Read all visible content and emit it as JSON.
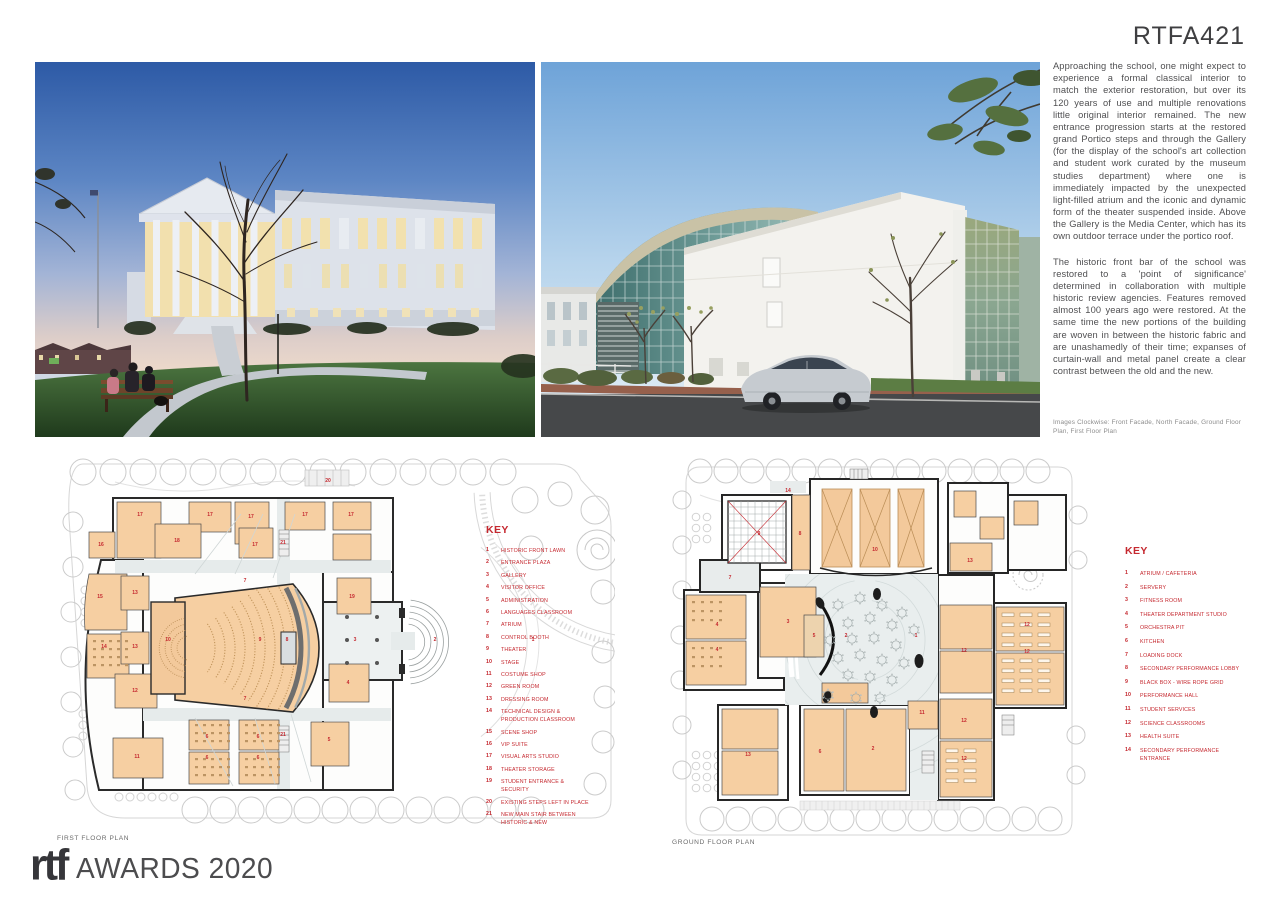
{
  "header": {
    "code": "RTFA421"
  },
  "article": {
    "paragraphs": [
      "Approaching the school, one might expect to experience a formal classical interior to match the exterior restoration, but over its 120 years of use and multiple renovations little original interior remained. The new entrance progression starts at the restored grand Portico steps and through the Gallery (for the display of the school's art collection and student work curated by the museum studies department) where one is immediately impacted by the unexpected light-filled atrium and the iconic and dynamic form of the theater suspended inside. Above the Gallery is the Media Center, which has its own outdoor terrace under the portico roof.",
      "The historic front bar of the school was restored to a 'point of significance' determined in collaboration with multiple historic review agencies. Features removed almost 100 years ago were restored. At the same time the new portions of the building are woven in between the historic fabric and are unashamedly of their time; expanses of curtain-wall and metal panel create a clear contrast between the old and the new."
    ],
    "caption": "Images Clockwise: Front Facade, North Facade, Ground Floor Plan, First Floor Plan"
  },
  "plans": {
    "first": {
      "label": "FIRST FLOOR PLAN",
      "key_title": "KEY",
      "key": [
        {
          "n": "1",
          "label": "HISTORIC FRONT LAWN"
        },
        {
          "n": "2",
          "label": "ENTRANCE PLAZA"
        },
        {
          "n": "3",
          "label": "GALLERY"
        },
        {
          "n": "4",
          "label": "VISITOR OFFICE"
        },
        {
          "n": "5",
          "label": "ADMINISTRATION"
        },
        {
          "n": "6",
          "label": "LANGUAGES CLASSROOM"
        },
        {
          "n": "7",
          "label": "ATRIUM"
        },
        {
          "n": "8",
          "label": "CONTROL BOOTH"
        },
        {
          "n": "9",
          "label": "THEATER"
        },
        {
          "n": "10",
          "label": "STAGE"
        },
        {
          "n": "11",
          "label": "COSTUME SHOP"
        },
        {
          "n": "12",
          "label": "GREEN ROOM"
        },
        {
          "n": "13",
          "label": "DRESSING ROOM"
        },
        {
          "n": "14",
          "label": "TECHNICAL DESIGN & PRODUCTION CLASSROOM"
        },
        {
          "n": "15",
          "label": "SCENE SHOP"
        },
        {
          "n": "16",
          "label": "VIP SUITE"
        },
        {
          "n": "17",
          "label": "VISUAL ARTS STUDIO"
        },
        {
          "n": "18",
          "label": "THEATER STORAGE"
        },
        {
          "n": "19",
          "label": "STUDENT ENTRANCE & SECURITY"
        },
        {
          "n": "20",
          "label": "EXISTING STEPS LEFT IN PLACE"
        },
        {
          "n": "21",
          "label": "NEW MAIN STAIR BETWEEN HISTORIC & NEW"
        }
      ],
      "room_labels": [
        {
          "t": "20",
          "x": 273,
          "y": 30
        },
        {
          "t": "17",
          "x": 85,
          "y": 64
        },
        {
          "t": "17",
          "x": 155,
          "y": 64
        },
        {
          "t": "17",
          "x": 196,
          "y": 66
        },
        {
          "t": "17",
          "x": 250,
          "y": 64
        },
        {
          "t": "17",
          "x": 296,
          "y": 64
        },
        {
          "t": "16",
          "x": 46,
          "y": 94
        },
        {
          "t": "18",
          "x": 122,
          "y": 90
        },
        {
          "t": "17",
          "x": 200,
          "y": 94
        },
        {
          "t": "21",
          "x": 228,
          "y": 92
        },
        {
          "t": "15",
          "x": 45,
          "y": 146
        },
        {
          "t": "13",
          "x": 80,
          "y": 142
        },
        {
          "t": "7",
          "x": 190,
          "y": 130
        },
        {
          "t": "19",
          "x": 297,
          "y": 146
        },
        {
          "t": "14",
          "x": 49,
          "y": 196
        },
        {
          "t": "13",
          "x": 80,
          "y": 196
        },
        {
          "t": "10",
          "x": 113,
          "y": 189
        },
        {
          "t": "9",
          "x": 205,
          "y": 189
        },
        {
          "t": "8",
          "x": 232,
          "y": 189
        },
        {
          "t": "3",
          "x": 300,
          "y": 189
        },
        {
          "t": "2",
          "x": 380,
          "y": 189
        },
        {
          "t": "1",
          "x": 478,
          "y": 189
        },
        {
          "t": "12",
          "x": 80,
          "y": 240
        },
        {
          "t": "7",
          "x": 190,
          "y": 248
        },
        {
          "t": "4",
          "x": 293,
          "y": 232
        },
        {
          "t": "11",
          "x": 82,
          "y": 306
        },
        {
          "t": "6",
          "x": 152,
          "y": 286
        },
        {
          "t": "6",
          "x": 203,
          "y": 286
        },
        {
          "t": "21",
          "x": 228,
          "y": 284
        },
        {
          "t": "5",
          "x": 274,
          "y": 289
        },
        {
          "t": "6",
          "x": 152,
          "y": 307
        },
        {
          "t": "6",
          "x": 203,
          "y": 307
        }
      ]
    },
    "ground": {
      "label": "GROUND FLOOR PLAN",
      "key_title": "KEY",
      "key": [
        {
          "n": "1",
          "label": "ATRIUM / CAFETERIA"
        },
        {
          "n": "2",
          "label": "SERVERY"
        },
        {
          "n": "3",
          "label": "FITNESS ROOM"
        },
        {
          "n": "4",
          "label": "THEATER DEPARTMENT STUDIO"
        },
        {
          "n": "5",
          "label": "ORCHESTRA PIT"
        },
        {
          "n": "6",
          "label": "KITCHEN"
        },
        {
          "n": "7",
          "label": "LOADING DOCK"
        },
        {
          "n": "8",
          "label": "SECONDARY PERFORMANCE LOBBY"
        },
        {
          "n": "9",
          "label": "BLACK BOX - WIRE ROPE GRID"
        },
        {
          "n": "10",
          "label": "PERFORMANCE HALL"
        },
        {
          "n": "11",
          "label": "STUDENT SERVICES"
        },
        {
          "n": "12",
          "label": "SCIENCE CLASSROOMS"
        },
        {
          "n": "13",
          "label": "HEALTH SUITE"
        },
        {
          "n": "14",
          "label": "SECONDARY PERFORMANCE ENTRANCE"
        }
      ],
      "room_labels": [
        {
          "t": "14",
          "x": 118,
          "y": 37
        },
        {
          "t": "9",
          "x": 89,
          "y": 80
        },
        {
          "t": "8",
          "x": 130,
          "y": 80
        },
        {
          "t": "10",
          "x": 205,
          "y": 96
        },
        {
          "t": "13",
          "x": 300,
          "y": 107
        },
        {
          "t": "7",
          "x": 60,
          "y": 124
        },
        {
          "t": "4",
          "x": 47,
          "y": 171
        },
        {
          "t": "3",
          "x": 118,
          "y": 168
        },
        {
          "t": "5",
          "x": 144,
          "y": 182
        },
        {
          "t": "2",
          "x": 176,
          "y": 182
        },
        {
          "t": "1",
          "x": 246,
          "y": 182
        },
        {
          "t": "12",
          "x": 357,
          "y": 171
        },
        {
          "t": "4",
          "x": 47,
          "y": 196
        },
        {
          "t": "12",
          "x": 294,
          "y": 197
        },
        {
          "t": "12",
          "x": 357,
          "y": 198
        },
        {
          "t": "11",
          "x": 252,
          "y": 259
        },
        {
          "t": "12",
          "x": 294,
          "y": 267
        },
        {
          "t": "13",
          "x": 78,
          "y": 301
        },
        {
          "t": "6",
          "x": 150,
          "y": 298
        },
        {
          "t": "2",
          "x": 203,
          "y": 295
        },
        {
          "t": "12",
          "x": 294,
          "y": 305
        }
      ]
    }
  },
  "footer": {
    "logo_text": "rtf",
    "awards_text": "AWARDS 2020"
  },
  "colors": {
    "accent_red": "#c5282f",
    "room_tan": "#f6cfa2",
    "ink": "#3f3f41"
  }
}
